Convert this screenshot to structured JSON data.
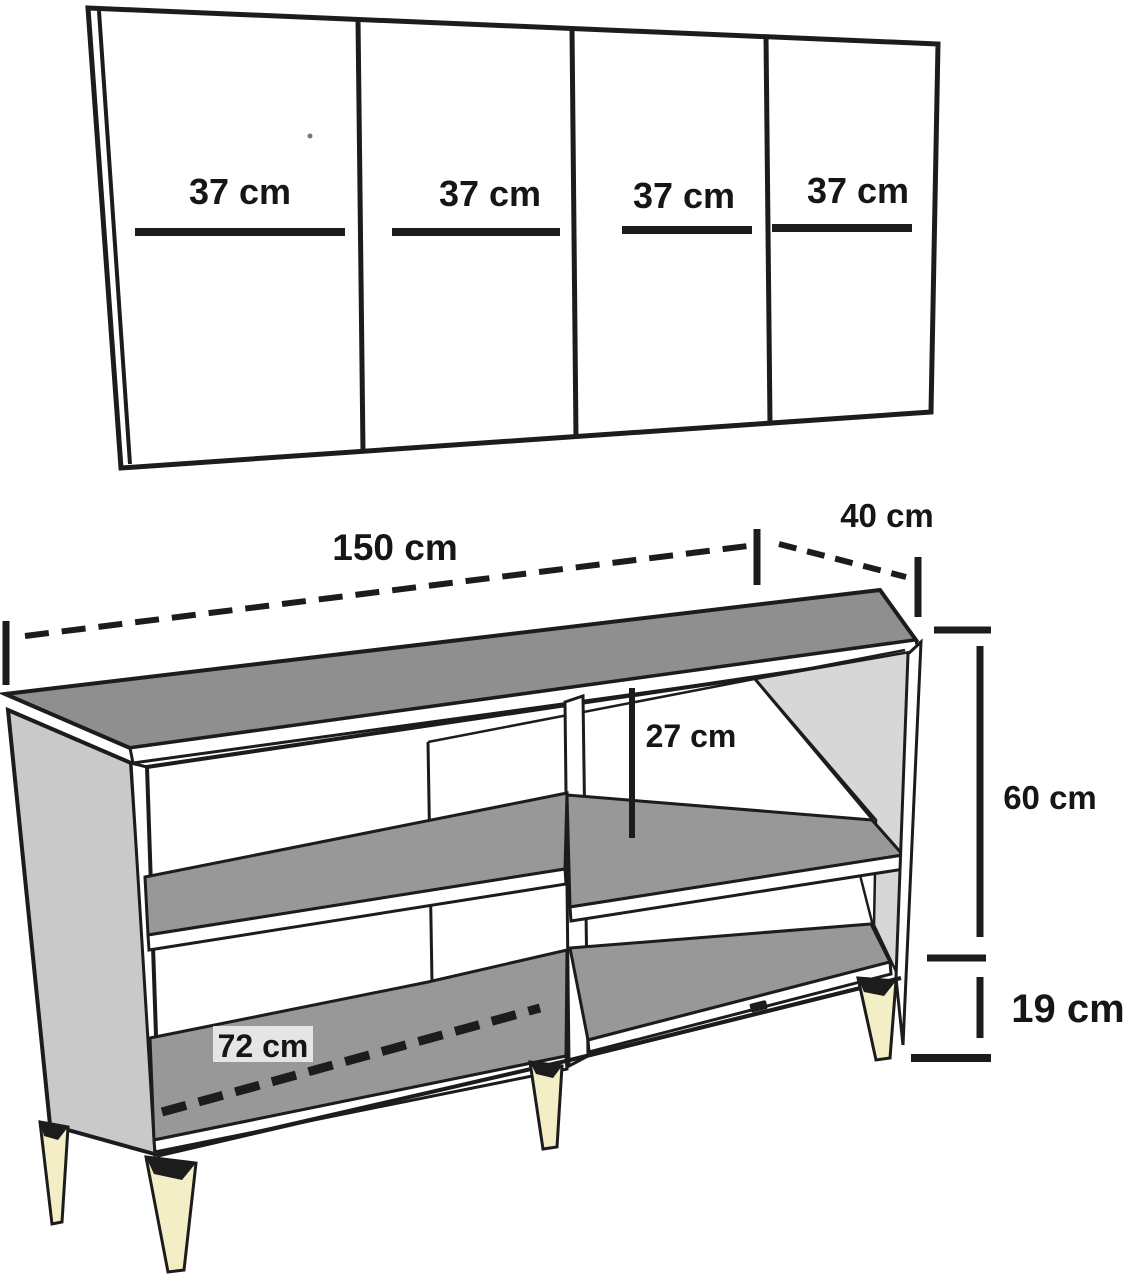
{
  "figure": {
    "kind": "furniture-dimension-diagram",
    "views": [
      "door-panel-front",
      "carcass-3d"
    ]
  },
  "door_panel": {
    "doors": [
      {
        "label": "37 cm"
      },
      {
        "label": "37 cm"
      },
      {
        "label": "37 cm"
      },
      {
        "label": "37 cm"
      }
    ]
  },
  "cabinet": {
    "dimensions": {
      "width": "150 cm",
      "depth": "40 cm",
      "height": "60 cm",
      "leg_height": "19 cm",
      "shelf_gap": "27 cm",
      "inner_width": "72 cm"
    }
  },
  "colors": {
    "outline": "#1c1c1c",
    "top_gray": "#8f8f8f",
    "shelf_gray": "#989898",
    "left_panel_gray": "#c9c9c9",
    "right_panel_gray": "#d7d7d7",
    "leg_cream": "#f3eec6",
    "background": "#ffffff"
  }
}
